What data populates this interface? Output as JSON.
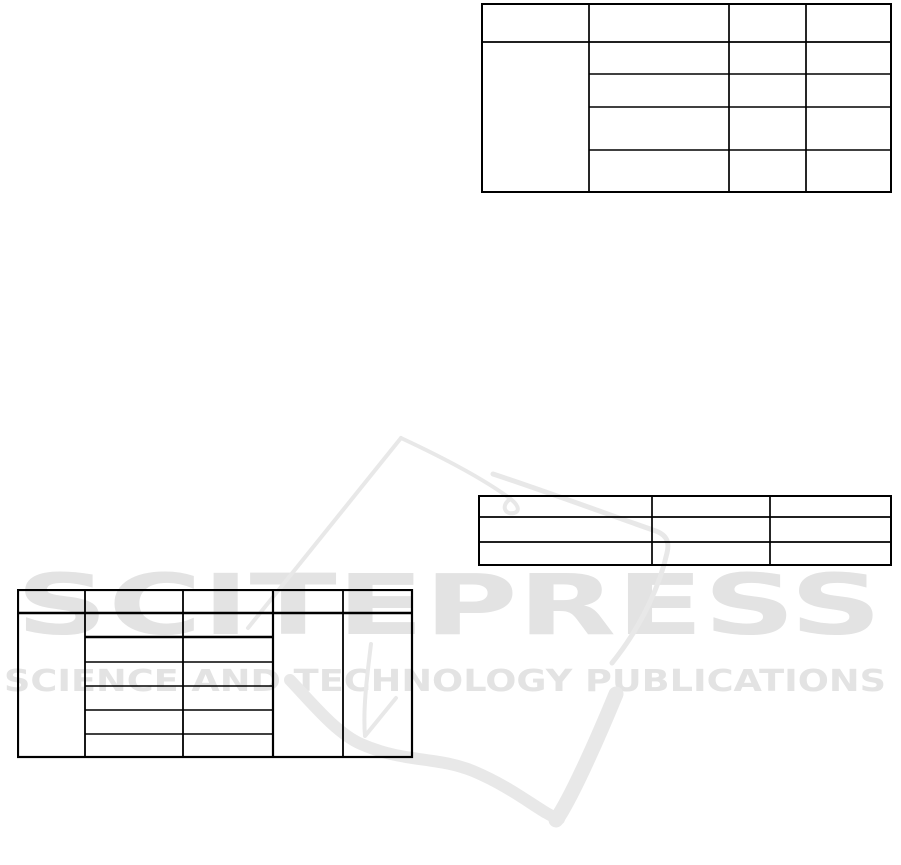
{
  "page": {
    "background_color": "#ffffff",
    "width_px": 901,
    "height_px": 865
  },
  "watermark": {
    "brand_text": "SCITEPRESS",
    "tagline_text": "SCIENCE AND TECHNOLOGY PUBLICATIONS",
    "text_color": "#e3e3e3",
    "graphic_color": "#e8e8e8",
    "graphic_name": "scitepress-quill-swoosh-logo"
  },
  "tables": {
    "border_color": "#000000",
    "top_right": {
      "columns": 4,
      "header_rows": 1,
      "body_rows": 4,
      "first_column_merged_over_body_rows": true,
      "visible_cell_text": ""
    },
    "middle_right": {
      "columns": 3,
      "rows": 3,
      "visible_cell_text": ""
    },
    "bottom_left": {
      "columns": 5,
      "header_rows": 1,
      "body_rows": 6,
      "merged_single_cell_columns": [
        1,
        4,
        5
      ],
      "visible_cell_text": ""
    }
  }
}
